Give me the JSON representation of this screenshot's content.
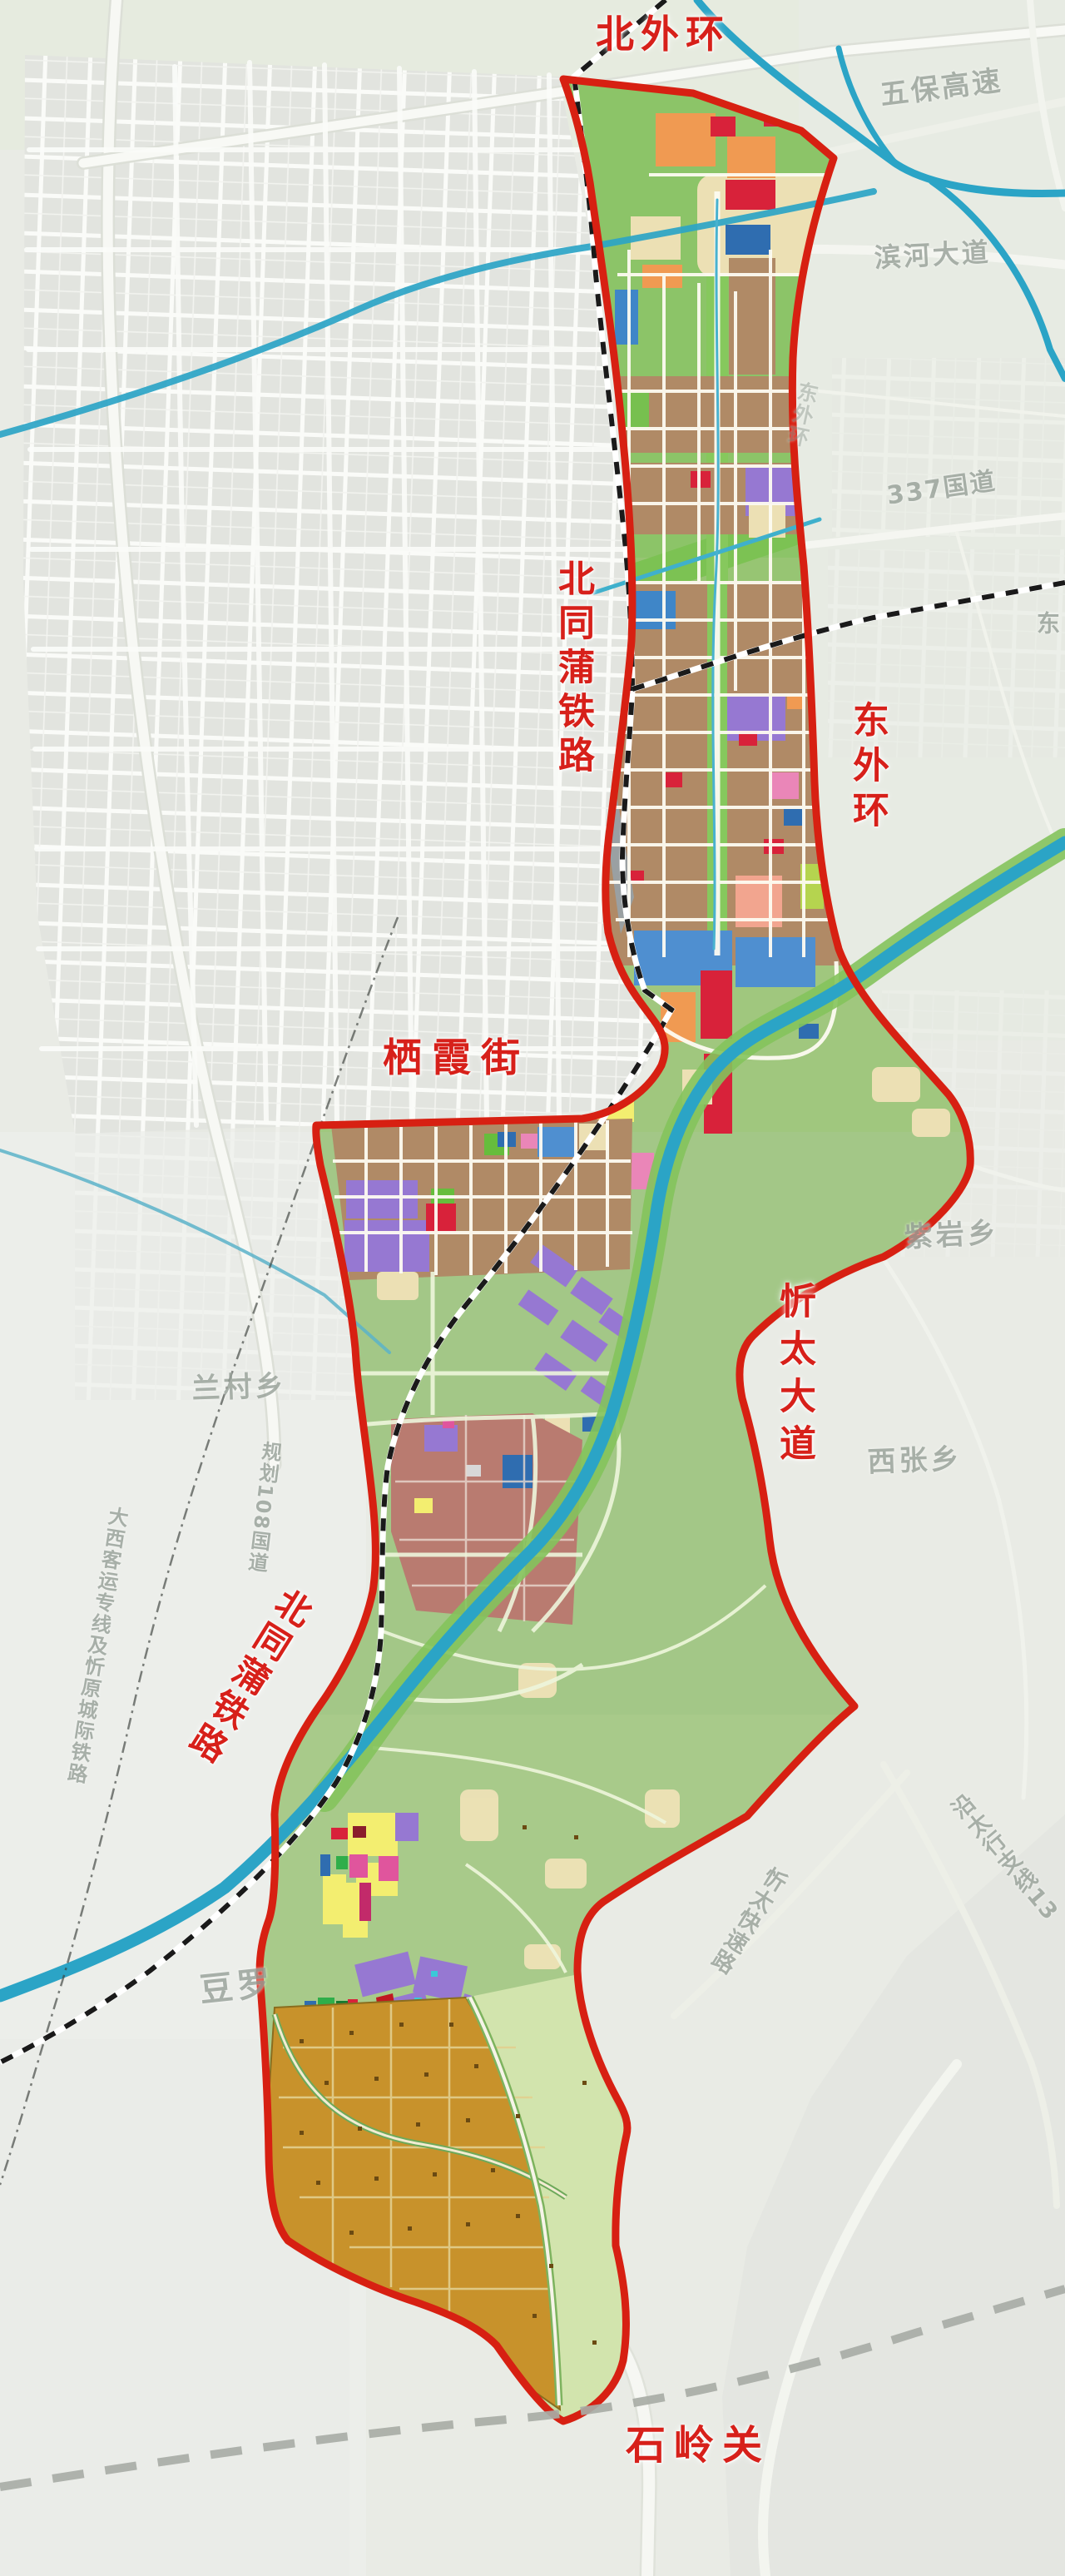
{
  "road_labels_red": {
    "north_outer_ring": "北外环",
    "beitongpu_railway_upper": "北同蒲铁路",
    "east_outer_ring": "东外环",
    "qixia_street": "栖霞街",
    "xintai_avenue": "忻太大道",
    "beitongpu_railway_lower": "北同蒲铁路",
    "shiling_pass": "石岭关"
  },
  "place_labels_gray": {
    "wubao_expressway": "五保高速",
    "binhe_avenue": "滨河大道",
    "national_road_337": "337国道",
    "dong_partial": "东",
    "east_ring_road": "东外环",
    "ziyan_township": "紫岩乡",
    "xizhang_township": "西张乡",
    "lancun_township": "兰村乡",
    "planned_g108": "规划108国道",
    "daxi_intercity_railway": "大西客运专线及忻原城际铁路",
    "douluo": "豆罗",
    "xintai_expressway": "忻太快速路",
    "yantaihang_branch_13": "沿太行支线13"
  },
  "colors": {
    "boundary_red": "#d72012",
    "water_teal": "#2ba4c6",
    "residential_brown": "#b08a66",
    "park_green": "#7cc253",
    "commercial_red": "#d8223a",
    "mixed_purple": "#9678d2",
    "public_blue": "#4f8fd0",
    "industrial_mauve": "#b97b70",
    "village_yellow": "#f3ee70",
    "farmland_ochre": "#c8922b",
    "education_orange": "#f09a52"
  }
}
